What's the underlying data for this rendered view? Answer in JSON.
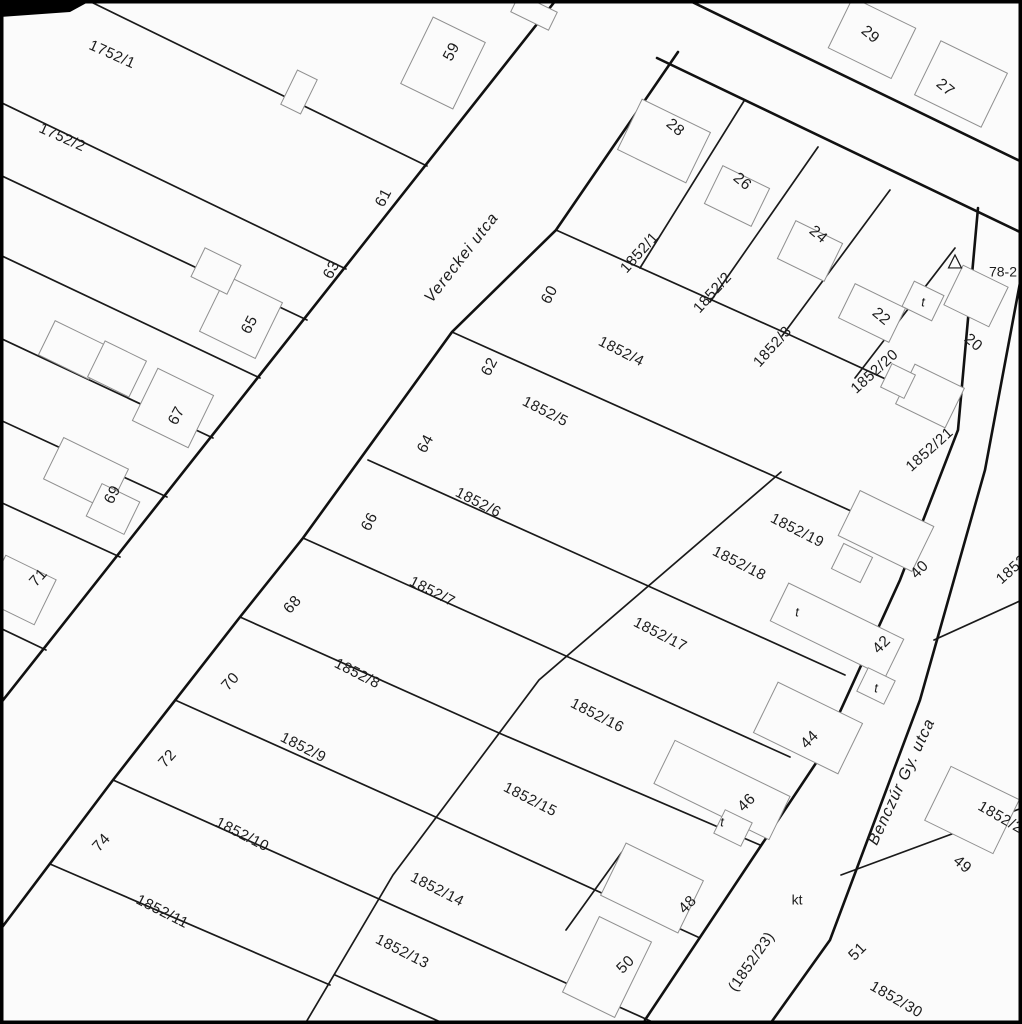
{
  "map": {
    "title": "cadastral-parcel-map",
    "background_color": "#fbfbfb",
    "line_color": "#111111",
    "building_color": "#8f8f8f",
    "text_color": "#1c1c1c",
    "streets": [
      {
        "name": "Vereckei utca",
        "x": 462,
        "y": 258,
        "rot": -52
      },
      {
        "name": "Benczúr Gy. utca",
        "x": 902,
        "y": 782,
        "rot": -65
      }
    ],
    "street_lines": [
      {
        "name": "vereckei-west-edge",
        "pts": [
          [
            556,
            0
          ],
          [
            0,
            704
          ]
        ]
      },
      {
        "name": "vereckei-east-edge",
        "pts": [
          [
            678,
            52
          ],
          [
            556,
            230
          ],
          [
            452,
            332
          ],
          [
            303,
            538
          ],
          [
            240,
            617
          ],
          [
            113,
            780
          ],
          [
            0,
            930
          ]
        ]
      },
      {
        "name": "north-street-north-edge",
        "pts": [
          [
            688,
            0
          ],
          [
            1022,
            162
          ]
        ]
      },
      {
        "name": "north-street-south-edge",
        "pts": [
          [
            657,
            58
          ],
          [
            1022,
            233
          ]
        ]
      },
      {
        "name": "benczur-west-edge",
        "pts": [
          [
            978,
            208
          ],
          [
            958,
            430
          ],
          [
            900,
            580
          ],
          [
            818,
            760
          ],
          [
            645,
            1020
          ]
        ]
      },
      {
        "name": "benczur-east-edge",
        "pts": [
          [
            1022,
            272
          ],
          [
            985,
            470
          ],
          [
            920,
            700
          ],
          [
            830,
            940
          ],
          [
            775,
            1017
          ],
          [
            770,
            1024
          ]
        ]
      }
    ],
    "parcel_lines": [
      {
        "name": "w-1",
        "pts": [
          [
            427,
            166
          ],
          [
            87,
            0
          ]
        ]
      },
      {
        "name": "w-2",
        "pts": [
          [
            346,
            269
          ],
          [
            0,
            102
          ]
        ]
      },
      {
        "name": "w-3",
        "pts": [
          [
            307,
            320
          ],
          [
            0,
            175
          ]
        ]
      },
      {
        "name": "w-4",
        "pts": [
          [
            260,
            378
          ],
          [
            0,
            255
          ]
        ]
      },
      {
        "name": "w-5",
        "pts": [
          [
            213,
            438
          ],
          [
            0,
            338
          ]
        ]
      },
      {
        "name": "w-6",
        "pts": [
          [
            167,
            497
          ],
          [
            0,
            420
          ]
        ]
      },
      {
        "name": "w-7",
        "pts": [
          [
            120,
            557
          ],
          [
            0,
            502
          ]
        ]
      },
      {
        "name": "w-8",
        "pts": [
          [
            46,
            650
          ],
          [
            0,
            628
          ]
        ]
      },
      {
        "name": "ne-div-1",
        "pts": [
          [
            744,
            101
          ],
          [
            640,
            268
          ]
        ]
      },
      {
        "name": "ne-div-2",
        "pts": [
          [
            818,
            147
          ],
          [
            710,
            302
          ]
        ]
      },
      {
        "name": "ne-div-3",
        "pts": [
          [
            890,
            190
          ],
          [
            782,
            336
          ]
        ]
      },
      {
        "name": "ne-div-4",
        "pts": [
          [
            955,
            248
          ],
          [
            855,
            378
          ]
        ]
      },
      {
        "name": "block-top",
        "pts": [
          [
            556,
            230
          ],
          [
            790,
            335
          ],
          [
            905,
            388
          ]
        ]
      },
      {
        "name": "e-fan-1",
        "pts": [
          [
            452,
            332
          ],
          [
            778,
            478
          ],
          [
            893,
            530
          ]
        ]
      },
      {
        "name": "e-fan-2",
        "pts": [
          [
            368,
            460
          ],
          [
            646,
            585
          ],
          [
            845,
            675
          ]
        ]
      },
      {
        "name": "e-fan-3",
        "pts": [
          [
            303,
            538
          ],
          [
            566,
            656
          ],
          [
            790,
            757
          ]
        ]
      },
      {
        "name": "e-fan-4",
        "pts": [
          [
            240,
            617
          ],
          [
            499,
            733
          ],
          [
            760,
            845
          ]
        ]
      },
      {
        "name": "e-fan-5",
        "pts": [
          [
            175,
            700
          ],
          [
            429,
            814
          ],
          [
            700,
            938
          ]
        ]
      },
      {
        "name": "e-fan-6",
        "pts": [
          [
            113,
            780
          ],
          [
            379,
            899
          ],
          [
            657,
            1024
          ]
        ]
      },
      {
        "name": "e-fan-7",
        "pts": [
          [
            50,
            864
          ],
          [
            330,
            985
          ]
        ]
      },
      {
        "name": "e-fan-8",
        "pts": [
          [
            335,
            975
          ],
          [
            445,
            1024
          ]
        ]
      },
      {
        "name": "back-line",
        "pts": [
          [
            781,
            472
          ],
          [
            539,
            680
          ],
          [
            393,
            875
          ],
          [
            305,
            1024
          ]
        ]
      },
      {
        "name": "div-48-50",
        "pts": [
          [
            622,
            852
          ],
          [
            566,
            930
          ]
        ]
      },
      {
        "name": "se-div-1",
        "pts": [
          [
            934,
            640
          ],
          [
            1022,
            600
          ]
        ]
      },
      {
        "name": "se-div-2",
        "pts": [
          [
            841,
            875
          ],
          [
            1022,
            808
          ]
        ]
      }
    ],
    "buildings": [
      {
        "name": "house-59",
        "cx": 443,
        "cy": 63,
        "w": 58,
        "h": 74,
        "rot": 26
      },
      {
        "name": "shed-1752-1",
        "cx": 299,
        "cy": 92,
        "w": 22,
        "h": 38,
        "rot": 26
      },
      {
        "name": "house-65",
        "cx": 241,
        "cy": 317,
        "w": 62,
        "h": 62,
        "rot": 26
      },
      {
        "name": "house-65-ext",
        "cx": 216,
        "cy": 271,
        "w": 40,
        "h": 32,
        "rot": 26
      },
      {
        "name": "house-67",
        "cx": 173,
        "cy": 408,
        "w": 62,
        "h": 58,
        "rot": 26
      },
      {
        "name": "house-1752-2a",
        "cx": 72,
        "cy": 350,
        "w": 56,
        "h": 38,
        "rot": 26
      },
      {
        "name": "house-1752-2b",
        "cx": 117,
        "cy": 369,
        "w": 46,
        "h": 40,
        "rot": 26
      },
      {
        "name": "house-69a",
        "cx": 86,
        "cy": 474,
        "w": 72,
        "h": 46,
        "rot": 26
      },
      {
        "name": "house-69b",
        "cx": 113,
        "cy": 509,
        "w": 42,
        "h": 36,
        "rot": 26
      },
      {
        "name": "house-71",
        "cx": 20,
        "cy": 590,
        "w": 56,
        "h": 50,
        "rot": 26
      },
      {
        "name": "house-29",
        "cx": 872,
        "cy": 38,
        "w": 70,
        "h": 56,
        "rot": 26
      },
      {
        "name": "house-27",
        "cx": 961,
        "cy": 84,
        "w": 74,
        "h": 60,
        "rot": 26
      },
      {
        "name": "house-28",
        "cx": 664,
        "cy": 141,
        "w": 76,
        "h": 56,
        "rot": 26
      },
      {
        "name": "house-26",
        "cx": 737,
        "cy": 196,
        "w": 52,
        "h": 42,
        "rot": 26
      },
      {
        "name": "house-24",
        "cx": 810,
        "cy": 251,
        "w": 52,
        "h": 42,
        "rot": 26
      },
      {
        "name": "house-22",
        "cx": 872,
        "cy": 313,
        "w": 56,
        "h": 38,
        "rot": 26
      },
      {
        "name": "t-bldg-1",
        "cx": 923,
        "cy": 301,
        "w": 33,
        "h": 28,
        "rot": 26
      },
      {
        "name": "house-20",
        "cx": 976,
        "cy": 296,
        "w": 50,
        "h": 44,
        "rot": 26
      },
      {
        "name": "bldg-1852-20a",
        "cx": 930,
        "cy": 396,
        "w": 55,
        "h": 44,
        "rot": 26
      },
      {
        "name": "bldg-1852-20b",
        "cx": 898,
        "cy": 381,
        "w": 26,
        "h": 26,
        "rot": 26
      },
      {
        "name": "house-40",
        "cx": 886,
        "cy": 531,
        "w": 82,
        "h": 50,
        "rot": 26
      },
      {
        "name": "house-40-ext",
        "cx": 852,
        "cy": 563,
        "w": 32,
        "h": 28,
        "rot": 26
      },
      {
        "name": "t-bldg-2",
        "cx": 797,
        "cy": 611,
        "w": 32,
        "h": 28,
        "rot": 26
      },
      {
        "name": "house-42",
        "cx": 837,
        "cy": 630,
        "w": 128,
        "h": 42,
        "rot": 26
      },
      {
        "name": "t-bldg-3",
        "cx": 876,
        "cy": 686,
        "w": 30,
        "h": 26,
        "rot": 26
      },
      {
        "name": "house-44",
        "cx": 808,
        "cy": 728,
        "w": 94,
        "h": 56,
        "rot": 26
      },
      {
        "name": "house-46",
        "cx": 722,
        "cy": 790,
        "w": 128,
        "h": 48,
        "rot": 26
      },
      {
        "name": "t-bldg-4",
        "cx": 733,
        "cy": 828,
        "w": 30,
        "h": 26,
        "rot": 26
      },
      {
        "name": "house-48",
        "cx": 652,
        "cy": 888,
        "w": 86,
        "h": 58,
        "rot": 26
      },
      {
        "name": "house-50",
        "cx": 607,
        "cy": 967,
        "w": 58,
        "h": 84,
        "rot": 26
      },
      {
        "name": "house-49",
        "cx": 972,
        "cy": 810,
        "w": 76,
        "h": 60,
        "rot": 26
      },
      {
        "name": "shed-top",
        "cx": 534,
        "cy": 12,
        "w": 42,
        "h": 20,
        "rot": 26
      }
    ],
    "parcel_labels": [
      {
        "text": "1752/1",
        "x": 112,
        "y": 55,
        "rot": 24
      },
      {
        "text": "1752/2",
        "x": 62,
        "y": 138,
        "rot": 24
      },
      {
        "text": "1852/1",
        "x": 640,
        "y": 253,
        "rot": -48
      },
      {
        "text": "1852/2",
        "x": 713,
        "y": 293,
        "rot": -48
      },
      {
        "text": "1852/3",
        "x": 773,
        "y": 347,
        "rot": -48
      },
      {
        "text": "1852/4",
        "x": 621,
        "y": 352,
        "rot": 27
      },
      {
        "text": "1852/5",
        "x": 545,
        "y": 412,
        "rot": 27
      },
      {
        "text": "1852/6",
        "x": 478,
        "y": 503,
        "rot": 27
      },
      {
        "text": "1852/7",
        "x": 432,
        "y": 592,
        "rot": 27
      },
      {
        "text": "1852/8",
        "x": 357,
        "y": 674,
        "rot": 27
      },
      {
        "text": "1852/9",
        "x": 303,
        "y": 748,
        "rot": 27
      },
      {
        "text": "1852/10",
        "x": 242,
        "y": 835,
        "rot": 27
      },
      {
        "text": "1852/11",
        "x": 162,
        "y": 912,
        "rot": 27
      },
      {
        "text": "1852/13",
        "x": 402,
        "y": 952,
        "rot": 27
      },
      {
        "text": "1852/14",
        "x": 437,
        "y": 890,
        "rot": 27
      },
      {
        "text": "1852/15",
        "x": 530,
        "y": 800,
        "rot": 27
      },
      {
        "text": "1852/16",
        "x": 597,
        "y": 716,
        "rot": 27
      },
      {
        "text": "1852/17",
        "x": 660,
        "y": 635,
        "rot": 27
      },
      {
        "text": "1852/18",
        "x": 739,
        "y": 564,
        "rot": 27
      },
      {
        "text": "1852/19",
        "x": 797,
        "y": 531,
        "rot": 27
      },
      {
        "text": "1852/20",
        "x": 875,
        "y": 372,
        "rot": -42
      },
      {
        "text": "1852/21",
        "x": 930,
        "y": 450,
        "rot": -42
      },
      {
        "text": "1852",
        "x": 1012,
        "y": 570,
        "rot": -42
      },
      {
        "text": "(1852/23)",
        "x": 752,
        "y": 962,
        "rot": -55
      },
      {
        "text": "1852/29",
        "x": 1004,
        "y": 820,
        "rot": 30
      },
      {
        "text": "1852/30",
        "x": 896,
        "y": 1000,
        "rot": 30
      }
    ],
    "house_numbers": [
      {
        "text": "59",
        "x": 452,
        "y": 52,
        "rot": -62
      },
      {
        "text": "61",
        "x": 384,
        "y": 198,
        "rot": -62
      },
      {
        "text": "63",
        "x": 332,
        "y": 270,
        "rot": -62
      },
      {
        "text": "65",
        "x": 250,
        "y": 325,
        "rot": -62
      },
      {
        "text": "67",
        "x": 177,
        "y": 416,
        "rot": -62
      },
      {
        "text": "69",
        "x": 113,
        "y": 495,
        "rot": -62
      },
      {
        "text": "71",
        "x": 39,
        "y": 578,
        "rot": -48
      },
      {
        "text": "60",
        "x": 550,
        "y": 295,
        "rot": -62
      },
      {
        "text": "62",
        "x": 490,
        "y": 367,
        "rot": -62
      },
      {
        "text": "64",
        "x": 426,
        "y": 444,
        "rot": -62
      },
      {
        "text": "66",
        "x": 370,
        "y": 522,
        "rot": -62
      },
      {
        "text": "68",
        "x": 293,
        "y": 605,
        "rot": -48
      },
      {
        "text": "70",
        "x": 231,
        "y": 682,
        "rot": -48
      },
      {
        "text": "72",
        "x": 168,
        "y": 759,
        "rot": -48
      },
      {
        "text": "74",
        "x": 102,
        "y": 843,
        "rot": -48
      },
      {
        "text": "29",
        "x": 870,
        "y": 35,
        "rot": 40
      },
      {
        "text": "27",
        "x": 945,
        "y": 88,
        "rot": 40
      },
      {
        "text": "28",
        "x": 675,
        "y": 128,
        "rot": 40
      },
      {
        "text": "26",
        "x": 742,
        "y": 182,
        "rot": 40
      },
      {
        "text": "24",
        "x": 818,
        "y": 235,
        "rot": 40
      },
      {
        "text": "22",
        "x": 881,
        "y": 317,
        "rot": 40
      },
      {
        "text": "20",
        "x": 973,
        "y": 343,
        "rot": 40
      },
      {
        "text": "40",
        "x": 920,
        "y": 570,
        "rot": -45
      },
      {
        "text": "42",
        "x": 882,
        "y": 645,
        "rot": -45
      },
      {
        "text": "44",
        "x": 810,
        "y": 740,
        "rot": -45
      },
      {
        "text": "46",
        "x": 747,
        "y": 803,
        "rot": -45
      },
      {
        "text": "48",
        "x": 688,
        "y": 905,
        "rot": -45
      },
      {
        "text": "50",
        "x": 626,
        "y": 965,
        "rot": -45
      },
      {
        "text": "49",
        "x": 962,
        "y": 865,
        "rot": 40
      },
      {
        "text": "51",
        "x": 858,
        "y": 952,
        "rot": -45
      }
    ],
    "small_markers": [
      {
        "text": "t",
        "x": 923,
        "y": 303
      },
      {
        "text": "t",
        "x": 797,
        "y": 613
      },
      {
        "text": "t",
        "x": 876,
        "y": 689
      },
      {
        "text": "t",
        "x": 722,
        "y": 823
      }
    ],
    "annotations": [
      {
        "text": "kt",
        "x": 797,
        "y": 901,
        "rot": 0
      },
      {
        "text": "78-2",
        "x": 1003,
        "y": 273,
        "rot": 0
      }
    ],
    "control_point": {
      "x": 955,
      "y": 263,
      "size": 13
    }
  }
}
